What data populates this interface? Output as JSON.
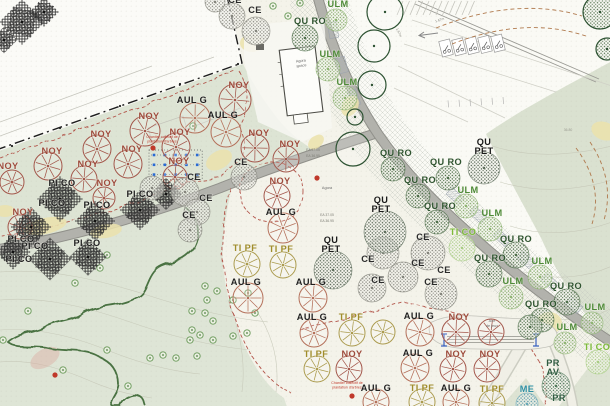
{
  "plan": {
    "colors": {
      "paper": "#f4f3ea",
      "sage_zone": "#dde4d4",
      "meadow": "#dee5d6",
      "field": "#dae1d0",
      "road": "#b2b2ac",
      "boundary": "#1d1d1d",
      "red_dashed": "#b2544a",
      "woodland_outline": "#4a7242",
      "blue_grid": "#2a6ad4",
      "red_marker": "#c0392b",
      "yellow_patch": "#ebe2ab",
      "utility_dashed": "#b07a4e"
    },
    "species_styles": {
      "NOY": {
        "label": "NOY",
        "label_color": "#9e4b3c",
        "glyph": "wheel",
        "color": "#a3564a"
      },
      "PI_CO": {
        "label": "PI CO",
        "label_color": "#1f1f1f",
        "glyph": "pine",
        "color": "#2e2e2e"
      },
      "CE": {
        "label": "CE",
        "label_color": "#2b2b2b",
        "glyph": "stipple",
        "color": "#84847c",
        "pattern": "dots-gray"
      },
      "AUL_G": {
        "label": "AUL G",
        "label_color": "#1f1f1f",
        "glyph": "wheel",
        "color": "#b4705a"
      },
      "QU_RO": {
        "label": "QU RO",
        "label_color": "#2f5430",
        "glyph": "stipple",
        "color": "#4e6e4a",
        "pattern": "dots-dkgreen"
      },
      "ULM": {
        "label": "ULM",
        "label_color": "#4e8a38",
        "glyph": "stipple",
        "color": "#8fb573",
        "pattern": "dots-green"
      },
      "QU_PET": {
        "label": "QU PET",
        "lines": [
          "QU",
          "PET"
        ],
        "label_color": "#1a1a1a",
        "glyph": "stipple",
        "color": "#5e6e5c",
        "pattern": "dots-dark"
      },
      "TI_PF": {
        "label": "TI PF",
        "label_color": "#a08d2c",
        "glyph": "wheel",
        "color": "#ab9b4e"
      },
      "TI_CO": {
        "label": "TI CO",
        "label_color": "#7dbb3a",
        "glyph": "stipple",
        "color": "#a9cd84",
        "pattern": "dots-ltgreen"
      },
      "PR_AV": {
        "label": "PR AV",
        "lines": [
          "PR",
          "AV"
        ],
        "label_color": "#2e5b40",
        "glyph": "stipple",
        "color": "#527a5c",
        "pattern": "dots-forest"
      },
      "ME": {
        "label": "ME",
        "label_color": "#2e8fa3",
        "glyph": "stipple",
        "color": "#68a8b8",
        "pattern": "dots-teal"
      },
      "PR": {
        "label": "PR",
        "label_color": "#2e5b40",
        "glyph": "none",
        "color": "#527a5c"
      }
    },
    "tree_labels": [
      [
        "NOY",
        239,
        88
      ],
      [
        "NOY",
        149,
        119
      ],
      [
        "NOY",
        101,
        137
      ],
      [
        "NOY",
        180,
        135
      ],
      [
        "NOY",
        52,
        154
      ],
      [
        "NOY",
        132,
        152
      ],
      [
        "NOY",
        259,
        136
      ],
      [
        "NOY",
        290,
        147
      ],
      [
        "NOY",
        88,
        167
      ],
      [
        "NOY",
        179,
        164
      ],
      [
        "NOY",
        280,
        184
      ],
      [
        "NOY",
        8,
        169
      ],
      [
        "NOY",
        23,
        215
      ],
      [
        "NOY",
        107,
        186
      ],
      [
        "NOY",
        459,
        320
      ],
      [
        "NOY",
        352,
        357
      ],
      [
        "NOY",
        456,
        357
      ],
      [
        "NOY",
        490,
        357
      ],
      [
        "PI_CO",
        62,
        186
      ],
      [
        "PI_CO",
        52,
        206
      ],
      [
        "PI_CO",
        97,
        208
      ],
      [
        "PI_CO",
        140,
        197
      ],
      [
        "PI_CO",
        21,
        242
      ],
      [
        "PI_CO",
        35,
        249
      ],
      [
        "PI_CO",
        87,
        246
      ],
      [
        "PI_CO",
        19,
        262
      ],
      [
        "CE",
        235,
        3
      ],
      [
        "CE",
        255,
        13
      ],
      [
        "CE",
        241,
        165
      ],
      [
        "CE",
        194,
        180
      ],
      [
        "CE",
        206,
        201
      ],
      [
        "CE",
        189,
        218
      ],
      [
        "CE",
        423,
        240
      ],
      [
        "CE",
        368,
        262
      ],
      [
        "CE",
        418,
        266
      ],
      [
        "CE",
        444,
        273
      ],
      [
        "CE",
        378,
        283
      ],
      [
        "CE",
        431,
        285
      ],
      [
        "AUL_G",
        192,
        103
      ],
      [
        "AUL_G",
        223,
        118
      ],
      [
        "AUL_G",
        281,
        215
      ],
      [
        "AUL_G",
        246,
        285
      ],
      [
        "AUL_G",
        311,
        285
      ],
      [
        "AUL_G",
        312,
        320
      ],
      [
        "AUL_G",
        419,
        319
      ],
      [
        "AUL_G",
        418,
        356
      ],
      [
        "AUL_G",
        376,
        391
      ],
      [
        "AUL_G",
        456,
        391
      ],
      [
        "QU_RO",
        310,
        24
      ],
      [
        "QU_RO",
        396,
        156
      ],
      [
        "QU_RO",
        446,
        165
      ],
      [
        "QU_RO",
        420,
        183
      ],
      [
        "QU_RO",
        440,
        209
      ],
      [
        "QU_RO",
        516,
        242
      ],
      [
        "QU_RO",
        490,
        261
      ],
      [
        "QU_RO",
        566,
        289
      ],
      [
        "QU_RO",
        541,
        307
      ],
      [
        "ULM",
        338,
        7
      ],
      [
        "ULM",
        330,
        57
      ],
      [
        "ULM",
        347,
        85
      ],
      [
        "ULM",
        468,
        193
      ],
      [
        "ULM",
        492,
        216
      ],
      [
        "ULM",
        542,
        264
      ],
      [
        "ULM",
        513,
        284
      ],
      [
        "ULM",
        595,
        310
      ],
      [
        "ULM",
        567,
        330
      ],
      [
        "QU_PET",
        484,
        145
      ],
      [
        "QU_PET",
        381,
        203
      ],
      [
        "QU_PET",
        331,
        243
      ],
      [
        "TI_PF",
        245,
        251
      ],
      [
        "TI_PF",
        281,
        252
      ],
      [
        "TI_PF",
        351,
        320
      ],
      [
        "TI_PF",
        316,
        357
      ],
      [
        "TI_PF",
        422,
        391
      ],
      [
        "TI_PF",
        492,
        392
      ],
      [
        "TI_CO",
        463,
        235
      ],
      [
        "TI_CO",
        597,
        350
      ],
      [
        "PR_AV",
        553,
        366
      ],
      [
        "PR",
        559,
        401
      ],
      [
        "ME",
        527,
        392
      ]
    ],
    "trees": [
      [
        "NOY",
        235,
        100,
        16
      ],
      [
        "NOY",
        145,
        131,
        15
      ],
      [
        "NOY",
        97,
        149,
        14
      ],
      [
        "NOY",
        176,
        147,
        14
      ],
      [
        "NOY",
        48,
        166,
        14
      ],
      [
        "NOY",
        128,
        164,
        14
      ],
      [
        "NOY",
        255,
        148,
        14
      ],
      [
        "NOY",
        286,
        159,
        13
      ],
      [
        "NOY",
        84,
        179,
        13
      ],
      [
        "NOY",
        175,
        177,
        12
      ],
      [
        "NOY",
        277,
        196,
        13
      ],
      [
        "NOY",
        12,
        182,
        12
      ],
      [
        "NOY",
        20,
        227,
        12
      ],
      [
        "NOY",
        104,
        198,
        11
      ],
      [
        "NOY",
        456,
        332,
        14
      ],
      [
        "NOY",
        349,
        369,
        13
      ],
      [
        "NOY",
        453,
        369,
        13
      ],
      [
        "NOY",
        487,
        369,
        13
      ],
      [
        "NOY",
        491,
        332,
        13
      ],
      [
        "PI_CO",
        60,
        199,
        17
      ],
      [
        "PI_CO",
        95,
        221,
        15
      ],
      [
        "PI_CO",
        31,
        227,
        15
      ],
      [
        "PI_CO",
        50,
        259,
        16
      ],
      [
        "PI_CO",
        13,
        252,
        13
      ],
      [
        "PI_CO",
        88,
        257,
        14
      ],
      [
        "PI_CO",
        140,
        210,
        15
      ],
      [
        "PI_CO",
        166,
        194,
        12
      ],
      [
        "PI_CO",
        22,
        22,
        17
      ],
      [
        "PI_CO",
        44,
        12,
        11
      ],
      [
        "PI_CO",
        4,
        40,
        10
      ],
      [
        "CE",
        232,
        16,
        13
      ],
      [
        "CE",
        256,
        31,
        14
      ],
      [
        "CE",
        215,
        2,
        10
      ],
      [
        "CE",
        244,
        177,
        13
      ],
      [
        "CE",
        185,
        192,
        14
      ],
      [
        "CE",
        197,
        212,
        13
      ],
      [
        "CE",
        152,
        188,
        12
      ],
      [
        "CE",
        190,
        230,
        12
      ],
      [
        "CE",
        428,
        253,
        17
      ],
      [
        "CE",
        383,
        253,
        16
      ],
      [
        "CE",
        403,
        277,
        15
      ],
      [
        "CE",
        441,
        294,
        16
      ],
      [
        "CE",
        372,
        288,
        14
      ],
      [
        "AUL_G",
        195,
        118,
        15
      ],
      [
        "AUL_G",
        226,
        132,
        15
      ],
      [
        "AUL_G",
        283,
        228,
        15
      ],
      [
        "AUL_G",
        248,
        298,
        15
      ],
      [
        "AUL_G",
        313,
        298,
        14
      ],
      [
        "AUL_G",
        314,
        333,
        14
      ],
      [
        "AUL_G",
        420,
        332,
        14
      ],
      [
        "AUL_G",
        415,
        368,
        14
      ],
      [
        "AUL_G",
        376,
        402,
        13
      ],
      [
        "AUL_G",
        456,
        402,
        13
      ],
      [
        "QU_RO",
        305,
        38,
        13
      ],
      [
        "QU_RO",
        393,
        169,
        12
      ],
      [
        "QU_RO",
        448,
        178,
        12
      ],
      [
        "QU_RO",
        418,
        196,
        12
      ],
      [
        "QU_RO",
        437,
        222,
        12
      ],
      [
        "QU_RO",
        516,
        255,
        13
      ],
      [
        "QU_RO",
        489,
        274,
        13
      ],
      [
        "QU_RO",
        567,
        302,
        13
      ],
      [
        "QU_RO",
        542,
        320,
        12
      ],
      [
        "QU_RO",
        530,
        327,
        12
      ],
      [
        "ULM",
        336,
        20,
        11
      ],
      [
        "ULM",
        328,
        69,
        12
      ],
      [
        "ULM",
        345,
        98,
        12
      ],
      [
        "ULM",
        466,
        206,
        12
      ],
      [
        "ULM",
        490,
        229,
        12
      ],
      [
        "ULM",
        540,
        277,
        12
      ],
      [
        "ULM",
        511,
        297,
        12
      ],
      [
        "ULM",
        592,
        323,
        11
      ],
      [
        "ULM",
        565,
        343,
        11
      ],
      [
        "QU_PET",
        484,
        168,
        16
      ],
      [
        "QU_PET",
        385,
        232,
        21
      ],
      [
        "QU_PET",
        333,
        270,
        19
      ],
      [
        "TI_PF",
        247,
        264,
        13
      ],
      [
        "TI_PF",
        283,
        265,
        13
      ],
      [
        "TI_PF",
        352,
        333,
        13
      ],
      [
        "TI_PF",
        317,
        369,
        13
      ],
      [
        "TI_PF",
        422,
        402,
        13
      ],
      [
        "TI_PF",
        492,
        403,
        13
      ],
      [
        "TI_PF",
        383,
        332,
        12
      ],
      [
        "TI_CO",
        462,
        248,
        13
      ],
      [
        "TI_CO",
        598,
        362,
        12
      ],
      [
        "PR_AV",
        556,
        386,
        14
      ],
      [
        "ME",
        527,
        404,
        11
      ]
    ],
    "existing_trees": [
      [
        385,
        12,
        18,
        0
      ],
      [
        374,
        46,
        16,
        0
      ],
      [
        372,
        85,
        14,
        0
      ],
      [
        355,
        117,
        8,
        0
      ],
      [
        353,
        149,
        17,
        0
      ],
      [
        600,
        12,
        17,
        1
      ],
      [
        607,
        49,
        11,
        1
      ]
    ],
    "shrubs": [
      [
        107,
        255
      ],
      [
        100,
        268
      ],
      [
        75,
        283
      ],
      [
        28,
        311
      ],
      [
        3,
        340
      ],
      [
        205,
        286
      ],
      [
        217,
        291
      ],
      [
        207,
        300
      ],
      [
        192,
        311
      ],
      [
        205,
        313
      ],
      [
        213,
        321
      ],
      [
        192,
        330
      ],
      [
        200,
        335
      ],
      [
        190,
        340
      ],
      [
        213,
        340
      ],
      [
        233,
        336
      ],
      [
        247,
        333
      ],
      [
        255,
        313
      ],
      [
        233,
        300
      ],
      [
        248,
        293
      ],
      [
        163,
        355
      ],
      [
        150,
        358
      ],
      [
        176,
        358
      ],
      [
        107,
        350
      ],
      [
        197,
        356
      ],
      [
        128,
        386
      ],
      [
        63,
        370
      ],
      [
        273,
        6
      ],
      [
        288,
        16
      ],
      [
        300,
        3
      ],
      [
        193,
        126
      ]
    ],
    "annotations": [
      {
        "lines": [
          "Agora",
          "space"
        ],
        "x": 301,
        "y": 62,
        "size": 3.8,
        "color": "#6a6a6a",
        "rotate": -7
      },
      {
        "lines": [
          "Agora"
        ],
        "x": 327,
        "y": 189,
        "size": 3.8,
        "color": "#6a6a6a"
      },
      {
        "lines": [
          "Aire",
          "de jeux"
        ],
        "x": 492,
        "y": 322,
        "size": 3.8,
        "color": "#6a6a6a"
      },
      {
        "lines": [
          "Chantier collectif de",
          "plantation d'arbres"
        ],
        "x": 162,
        "y": 138,
        "size": 3.6,
        "color": "#c0392b"
      },
      {
        "lines": [
          "Chantier collectif de",
          "plantation d'arbres"
        ],
        "x": 347,
        "y": 384,
        "size": 3.6,
        "color": "#c0392b"
      },
      {
        "lines": [
          "EA 37.05"
        ],
        "x": 313,
        "y": 151,
        "size": 3.4,
        "color": "#808078"
      },
      {
        "lines": [
          "EA 36.95"
        ],
        "x": 313,
        "y": 157,
        "size": 3.4,
        "color": "#808078"
      },
      {
        "lines": [
          "EA 37.05"
        ],
        "x": 327,
        "y": 216,
        "size": 3.4,
        "color": "#808078"
      },
      {
        "lines": [
          "EA 36.95"
        ],
        "x": 327,
        "y": 222,
        "size": 3.4,
        "color": "#808078"
      },
      {
        "lines": [
          "36.80"
        ],
        "x": 568,
        "y": 131,
        "size": 3.4,
        "color": "#9a9a90"
      },
      {
        "lines": [
          "1.67m"
        ],
        "x": 440,
        "y": 21,
        "size": 3.4,
        "color": "#8a8a82",
        "rotate": -18
      },
      {
        "lines": [
          "1.67m"
        ],
        "x": 398,
        "y": 33,
        "size": 3.4,
        "color": "#8a8a82",
        "rotate": 65
      }
    ],
    "markers": {
      "red_dots": [
        [
          153,
          148
        ],
        [
          317,
          178
        ],
        [
          55,
          375
        ],
        [
          352,
          396
        ]
      ],
      "blue_grid": {
        "x": 154,
        "y": 155,
        "dx": 10.8,
        "dy": 9.8,
        "cols": 5,
        "rows": 3
      }
    }
  }
}
